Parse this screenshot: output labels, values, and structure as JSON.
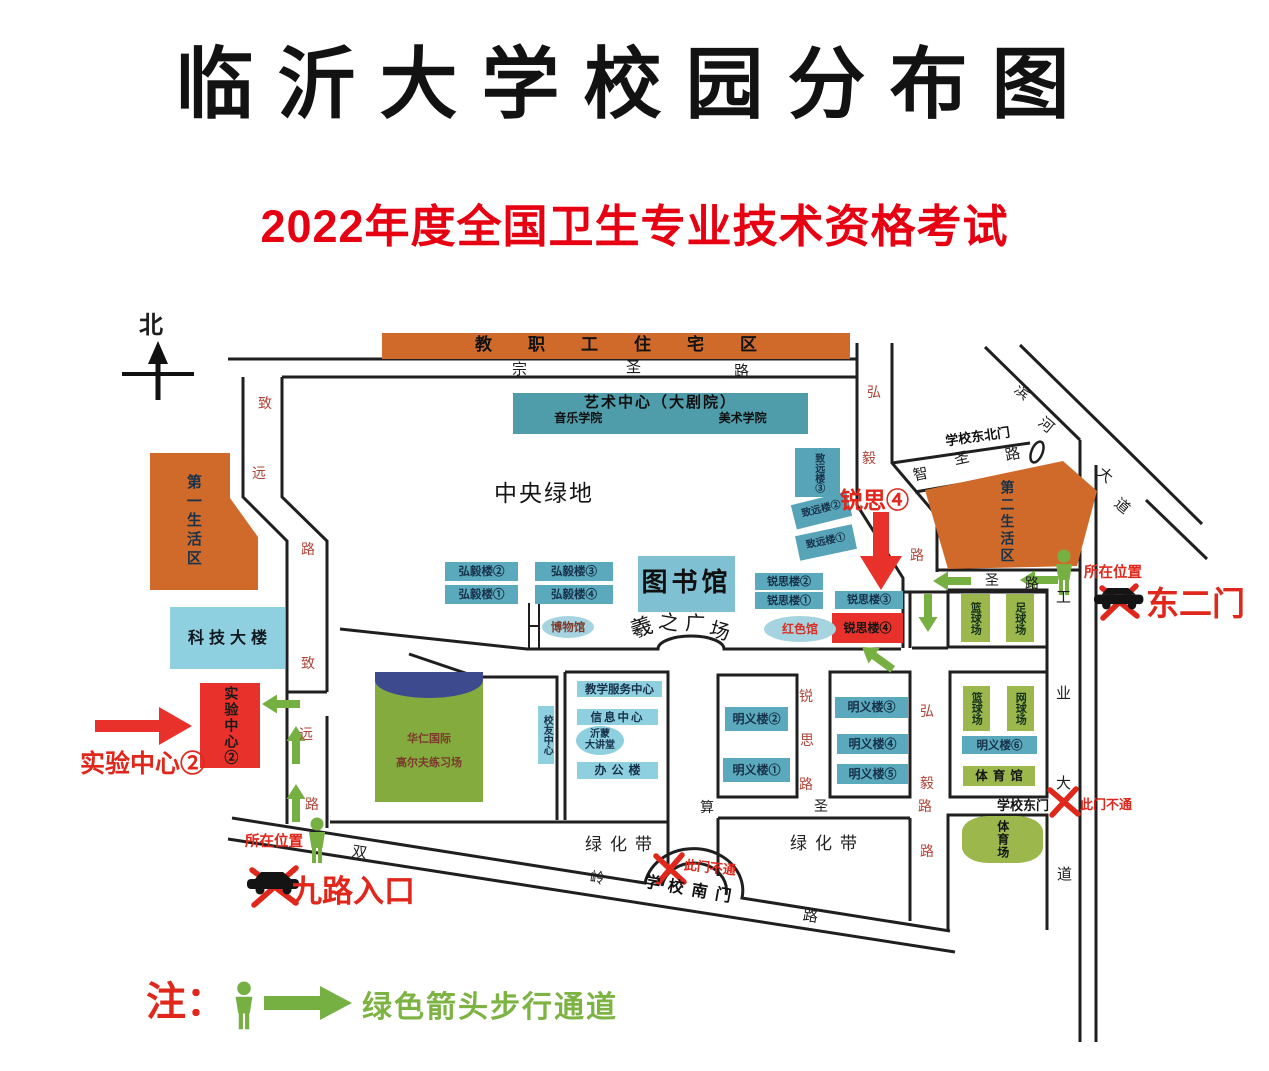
{
  "title": "临沂大学校园分布图",
  "subtitle": "2022年度全国卫生专业技术资格考试",
  "compass": {
    "north": "北"
  },
  "legend": {
    "note": "注：",
    "text": "绿色箭头步行通道"
  },
  "buildings": {
    "staff_housing": "教职工住宅区",
    "art_center": "艺术中心（大剧院）",
    "music_school": "音乐学院",
    "art_school": "美术学院",
    "central_green": "中央绿地",
    "living_area_1": "第一生活区",
    "living_area_2": "第二生活区",
    "tech_building": "科技大楼",
    "experiment_center": "实验中心②",
    "zhiyuan_3": "致远楼③",
    "zhiyuan_2": "致远楼②",
    "zhiyuan_1": "致远楼①",
    "hongyi_2": "弘毅楼②",
    "hongyi_3": "弘毅楼③",
    "hongyi_1": "弘毅楼①",
    "hongyi_4": "弘毅楼④",
    "library": "图书馆",
    "museum": "博物馆",
    "ruisi_2": "锐思楼②",
    "ruisi_1": "锐思楼①",
    "ruisi_3": "锐思楼③",
    "ruisi_4": "锐思楼④",
    "red_hall": "红色馆",
    "golf_1": "华仁国际",
    "golf_2": "高尔夫练习场",
    "alumni_center": "校友中心",
    "teaching_service": "教学服务中心",
    "info_center": "信息中心",
    "yimeng_1": "沂蒙",
    "yimeng_2": "大讲堂",
    "office": "办公楼",
    "mingyi_1": "明义楼①",
    "mingyi_2": "明义楼②",
    "mingyi_3": "明义楼③",
    "mingyi_4": "明义楼④",
    "mingyi_5": "明义楼⑤",
    "mingyi_6": "明义楼⑥",
    "basketball_n": "篮球场",
    "football": "足球场",
    "basketball_s": "篮球场",
    "tennis": "网球场",
    "gym": "体育馆",
    "stadium": "体育场",
    "greenbelt_w": "绿化带",
    "greenbelt_e": "绿化带"
  },
  "square": {
    "chars": [
      "羲",
      "之",
      "广",
      "场"
    ]
  },
  "roads": {
    "zongsheng": [
      "宗",
      "圣",
      "路"
    ],
    "zongsheng_east": [
      "圣",
      "路"
    ],
    "zhiyuan_upper": [
      "致",
      "远",
      "路"
    ],
    "zhiyuan_lower": [
      "致",
      "远",
      "路"
    ],
    "hongyi_upper": [
      "弘",
      "毅",
      "路"
    ],
    "hongyi_lower": [
      "弘",
      "毅",
      "路",
      "路"
    ],
    "ruisi": [
      "锐",
      "思",
      "路"
    ],
    "zhisheng": [
      "智",
      "圣",
      "路"
    ],
    "binhe": [
      "滨",
      "河",
      "大",
      "道"
    ],
    "gongye": [
      "工",
      "业",
      "大",
      "道"
    ],
    "shuangling": [
      "双",
      "岭",
      "路"
    ],
    "suansheng": [
      "算",
      "圣"
    ]
  },
  "gates": {
    "northeast": "学校东北门",
    "east": "学校东门",
    "south": "学校南门",
    "east2": "东二门",
    "blocked_south": "此门不通",
    "blocked_east": "此门不通",
    "jiulu": "九路入口"
  },
  "annotations": {
    "ruisi4_callout": "锐思④",
    "exam_center": "实验中心②",
    "you_are_here_w": "所在位置",
    "you_are_here_e": "所在位置"
  },
  "colors": {
    "orange": "#cf6a2a",
    "teal": "#5ba9bd",
    "teal_dark": "#4f9cab",
    "light_cyan": "#8fd0e0",
    "green": "#9cb84d",
    "red": "#e8312a",
    "title_red": "#e60012",
    "arrow_green": "#76b043",
    "navy": "#3d4b8e"
  }
}
